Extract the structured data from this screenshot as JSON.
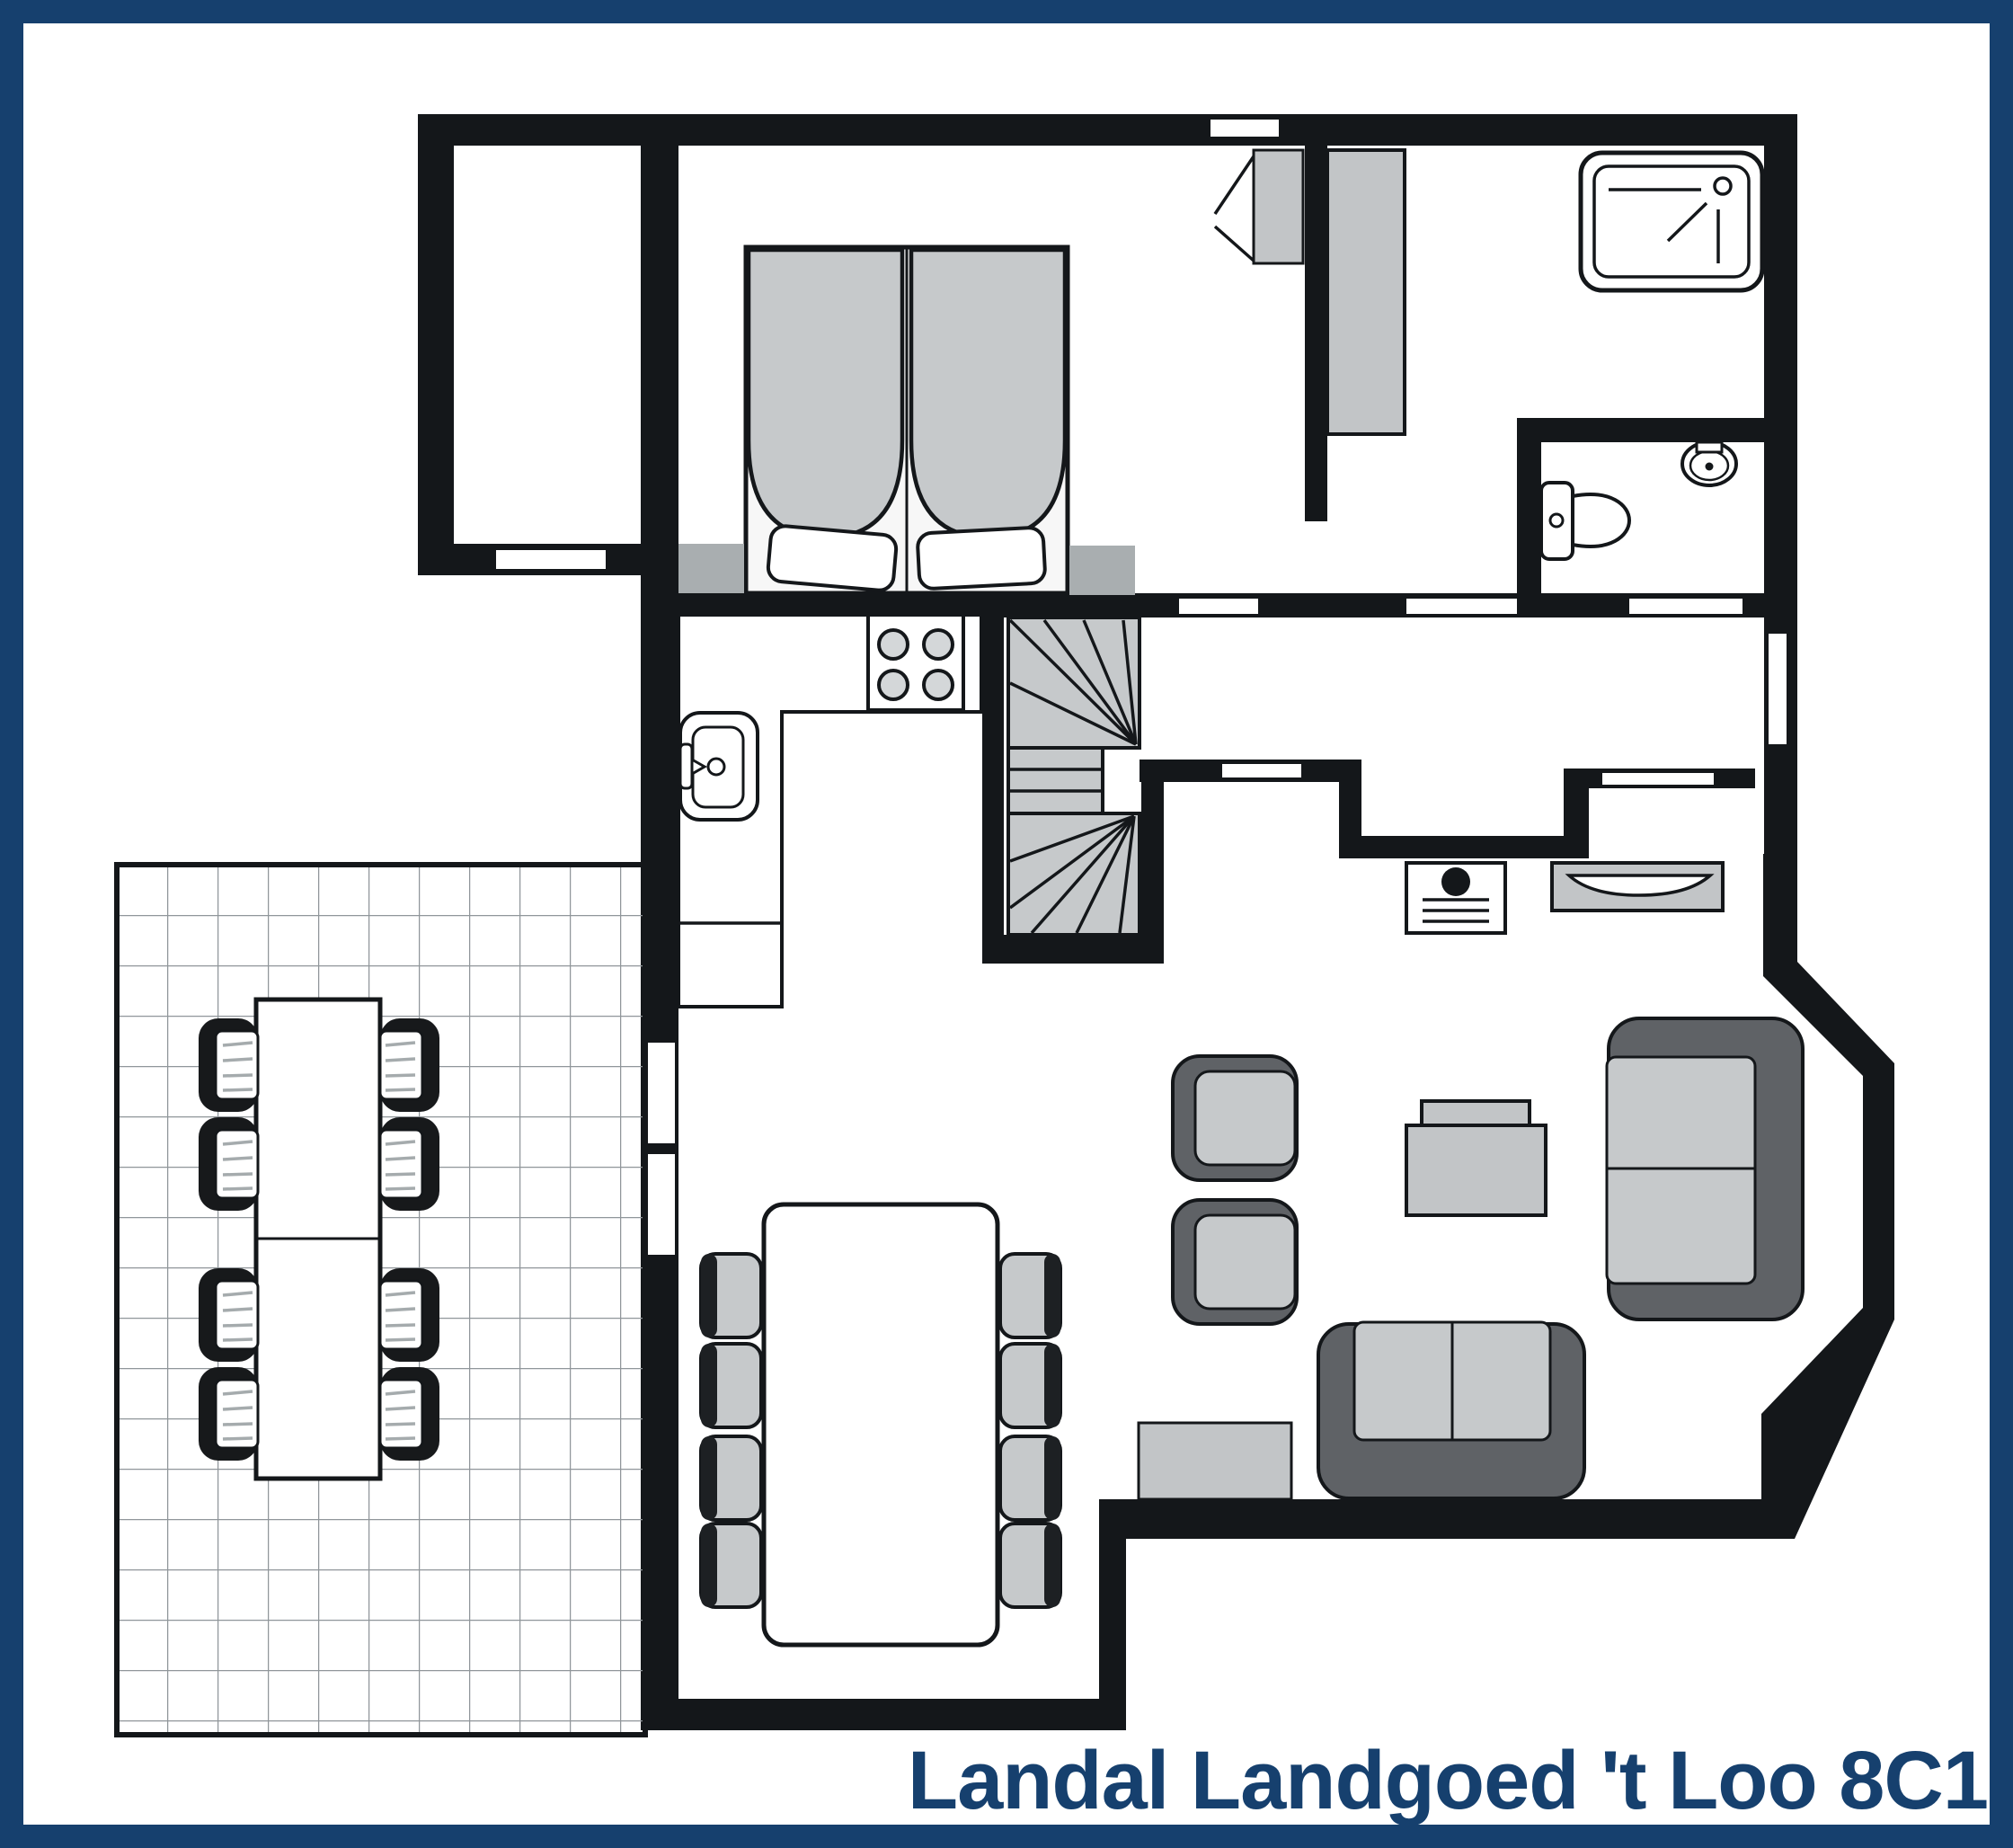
{
  "title": {
    "label": "Landal Landgoed 't Loo 8C1"
  },
  "colors": {
    "navy": "#16406e",
    "wall": "#14171a",
    "floor": "#ffffff",
    "furniture_light": "#c6c9cb",
    "furniture_mid": "#a9aeb0",
    "furniture_dark": "#5f6266",
    "chair_black": "#17191b",
    "grid": "#90969a",
    "burner": "#d4d7d9",
    "stripe": "#a5abad"
  }
}
